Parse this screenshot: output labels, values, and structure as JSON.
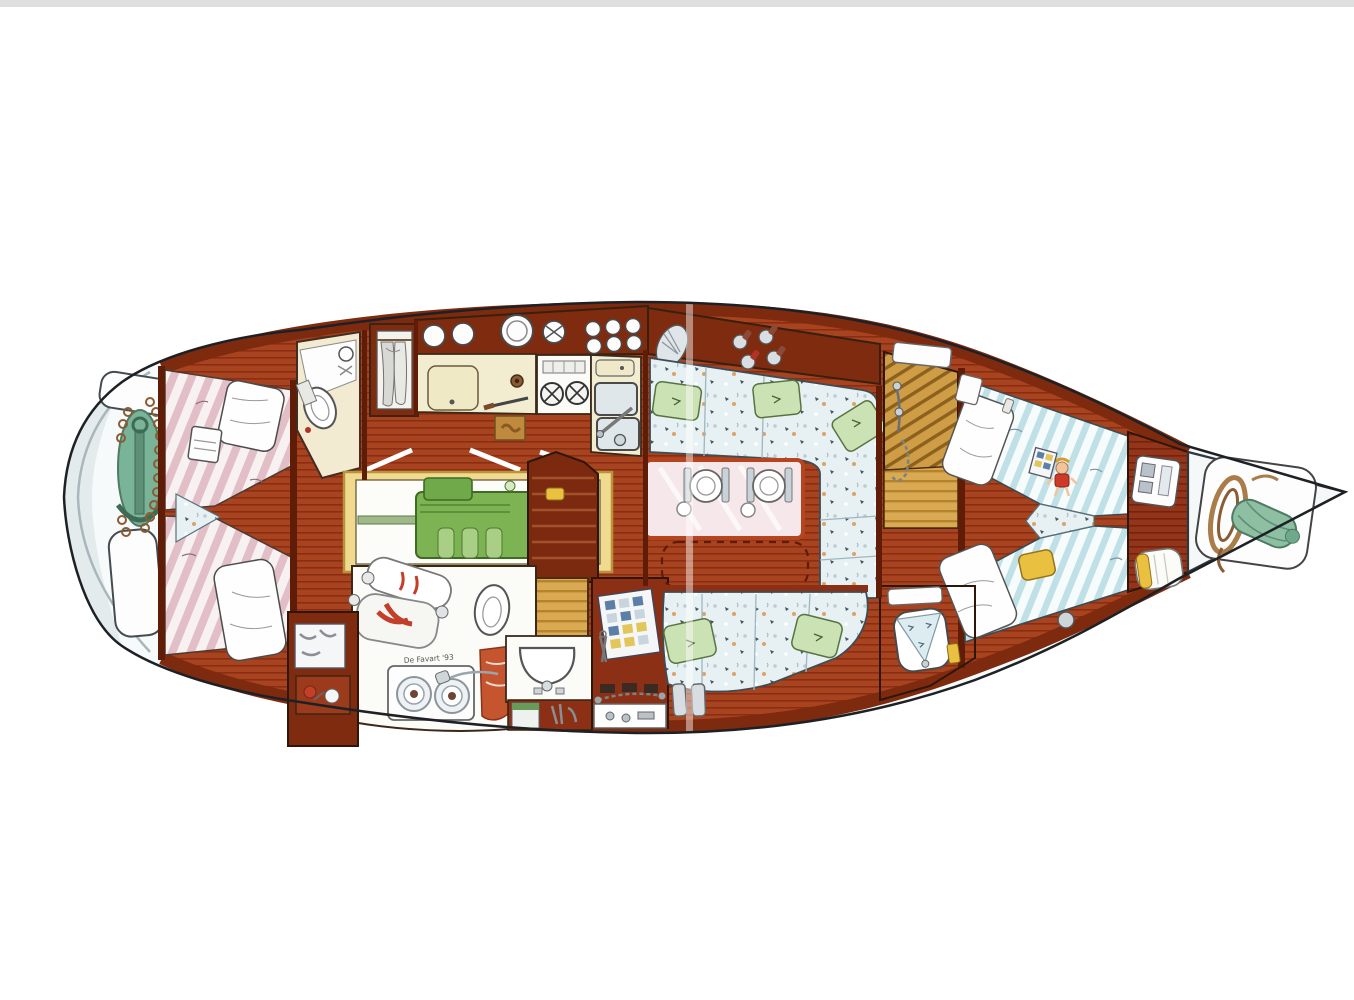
{
  "document": {
    "kind": "sailboat interior floor plan",
    "style": "hand-drawn colored illustration, top view",
    "orientation": "bow to the right, stern to the left"
  },
  "signature": "De Favart '93",
  "palette": {
    "hull_white": "#f7fafb",
    "hull_shade": "#dfe7ea",
    "wood_floor": "#a8431f",
    "wood_floor_line": "#8a2d12",
    "wood_cabinet": "#7e2b10",
    "teak_steps": "#d9aa52",
    "counter_cream": "#f2edd0",
    "engine_green": "#7cb453",
    "engine_frame_yellow": "#f0da8f",
    "bedding_pink": "#e2bec7",
    "bedding_blue": "#bfe0e6",
    "cushion_floral": "#e7f0f2",
    "pillow_green": "#cbe2b5",
    "pillow_yellow": "#e9c03f",
    "anchor_teal": "#79b398",
    "rope_brown": "#a97c4a",
    "scan_strip_gray": "#d9d9d9"
  },
  "areas": [
    {
      "id": "stern-lazarette",
      "name": "Stern lazarette with anchor and chain"
    },
    {
      "id": "aft-cabin",
      "name": "Aft cabin with twin berths in V layout"
    },
    {
      "id": "aft-head",
      "name": "Aft head with toilet and basin"
    },
    {
      "id": "hanging-locker",
      "name": "Hanging locker with clothes"
    },
    {
      "id": "galley",
      "name": "Galley with cutting board, 2-burner stove and twin sinks"
    },
    {
      "id": "engine-room",
      "name": "Engine room with green diesel engine and shaft"
    },
    {
      "id": "companionway-steps",
      "name": "Companionway steps"
    },
    {
      "id": "workshop",
      "name": "Utility room with dive tanks, washer and toilet"
    },
    {
      "id": "shower-room",
      "name": "Washroom with basin and lockers"
    },
    {
      "id": "tool-locker",
      "name": "Tool locker with pegboard"
    },
    {
      "id": "dinette",
      "name": "U-shaped dinette with laid table for two"
    },
    {
      "id": "saloon-settee",
      "name": "Saloon settee with floral cushions"
    },
    {
      "id": "pilot-berth",
      "name": "Slatted steps / stowage with rigging hardware"
    },
    {
      "id": "forward-cabin",
      "name": "Forward cabin with V berths, doll and pillows"
    },
    {
      "id": "forward-head",
      "name": "Forward washroom with decorated basin"
    },
    {
      "id": "bow-locker",
      "name": "Anchor locker with coiled warp and sail bag"
    }
  ],
  "details": {
    "galley_burners": 2,
    "galley_sinks": 3,
    "dinette_place_settings": 2,
    "portholes_on_shelf": 2,
    "small_round_stowage": 6,
    "wine_bottles": 4,
    "washer_doors": 2,
    "green_pillows": 5
  }
}
